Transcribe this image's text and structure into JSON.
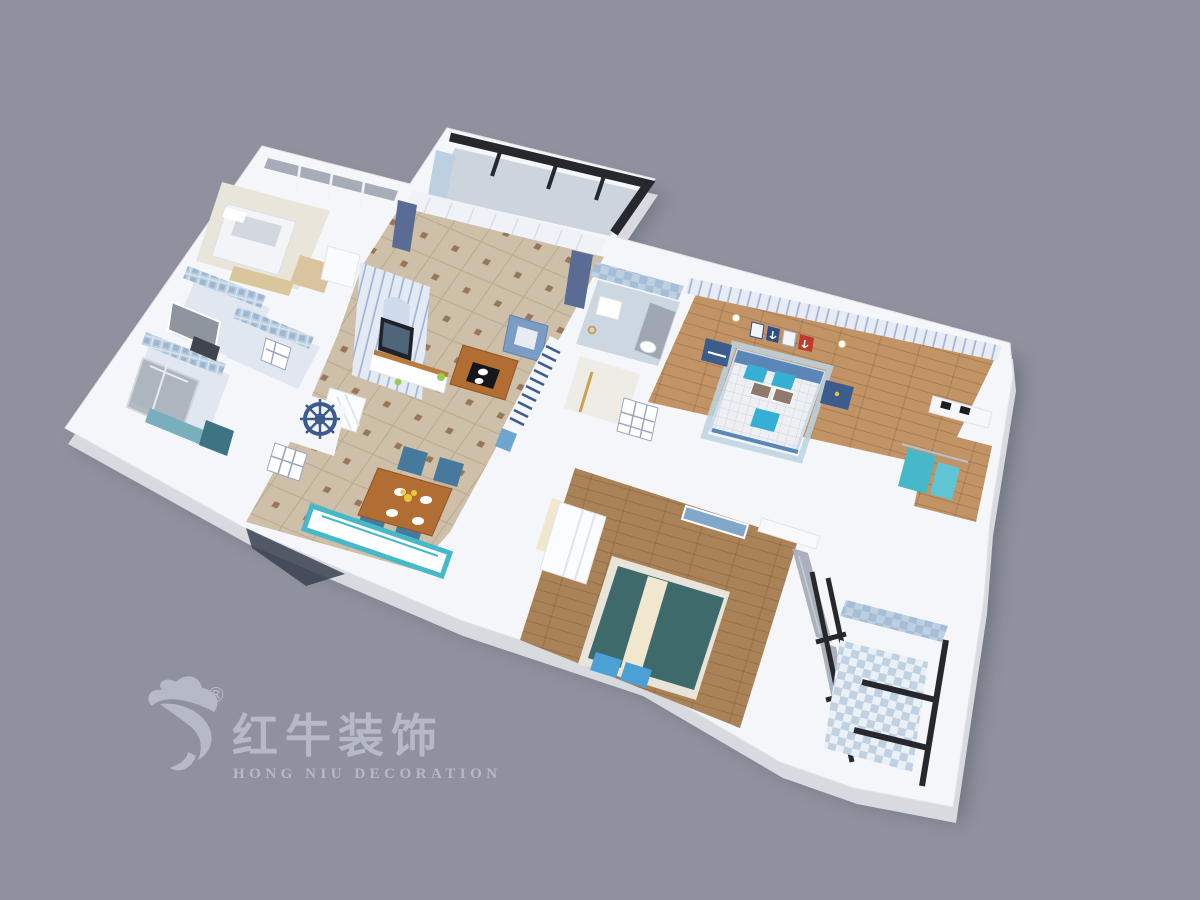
{
  "watermark": {
    "registered_mark": "®",
    "brand_cn": "红牛装饰",
    "brand_en": "HONG NIU DECORATION"
  },
  "scene": {
    "type": "3d-floor-plan-render",
    "style": "mediterranean-blue-white",
    "view": "tilted top-down axonometric, plan rotated clockwise"
  },
  "rooms": [
    {
      "id": "secondary-bedroom",
      "contents": [
        "white-bed",
        "corner-window",
        "wood-desk",
        "side-table"
      ]
    },
    {
      "id": "washroom",
      "contents": [
        "mirror",
        "mosaic-tile-walls"
      ]
    },
    {
      "id": "small-bathroom",
      "contents": [
        "window",
        "mosaic-tile-walls"
      ]
    },
    {
      "id": "shower-room",
      "contents": [
        "glass-shower",
        "teal-vanity",
        "dark-cabinet"
      ]
    },
    {
      "id": "living-room",
      "contents": [
        "striped-tv-wall",
        "tv-cabinet",
        "blue-armchair",
        "wood-coffee-table",
        "striped-sofa",
        "sheer-curtains",
        "navy-curtains",
        "ship-wheel-decor",
        "shoe-cabinet"
      ]
    },
    {
      "id": "north-balcony",
      "contents": [
        "black-frame-windows",
        "tile-wall"
      ]
    },
    {
      "id": "dining-area",
      "contents": [
        "wood-dining-table",
        "blue-chairs",
        "plates",
        "yellow-flowers",
        "teal-kitchen-counter",
        "paned-window"
      ]
    },
    {
      "id": "hall-bathroom",
      "contents": [
        "checker-tile-wall",
        "glass-shower",
        "toilet",
        "gold-threshold"
      ]
    },
    {
      "id": "hallway",
      "contents": [
        "cream-closet-floor",
        "six-pane-door",
        "tall-white-cabinet"
      ]
    },
    {
      "id": "kids-bedroom",
      "contents": [
        "striped-wallpaper",
        "quilted-bed",
        "cyan-pillows",
        "blue-headboard",
        "navy-nightstands",
        "anchor-wall-art",
        "wall-sconces",
        "blue-rug"
      ]
    },
    {
      "id": "dressing-study",
      "contents": [
        "white-desk",
        "black-boxes",
        "hanging-teal-clothes"
      ]
    },
    {
      "id": "master-bedroom",
      "contents": [
        "teal-bed",
        "cream-runner",
        "blue-pillows",
        "white-wardrobe",
        "seascape-art",
        "air-conditioner",
        "gray-curtains",
        "black-frame-windows"
      ]
    },
    {
      "id": "laundry-balcony",
      "contents": [
        "checker-tile-floor",
        "black-frame-windows"
      ]
    }
  ],
  "palette": {
    "bg": "#8f929e",
    "wall": "#f5f6f9",
    "wall_shade": "#dfe2e8",
    "slab_side": "#d8dae0",
    "shadow": "#4a4e5c",
    "tile_beige": "#cdbfa8",
    "tile_line": "#b9a88f",
    "tile_dot": "#8d6b4c",
    "bath_floor": "#e0e7f0",
    "tile_blue": "#bdd0e2",
    "tile_blue_dark": "#8fb0c8",
    "wood_light": "#c29465",
    "wood_mid": "#aa8257",
    "wood_pale": "#d9c49f",
    "glass": "#99a1ab",
    "frame_dark": "#26282d",
    "navy": "#3c5c8e",
    "steel_blue": "#5b86b8",
    "arm_blue": "#7b9cc4",
    "curtain_navy": "#5a6c94",
    "curtain_gray": "#a7adb8",
    "teal": "#45b8c9",
    "teal_dark": "#3f6a6b",
    "teal_cab": "#79aebc",
    "cyan_pillow": "#35b0d4",
    "pillow_blue": "#4ba0d6",
    "red_accent": "#c0392b",
    "table_wood": "#b26d33",
    "cream": "#f1e7cf",
    "logo": "#b6b9c6"
  }
}
